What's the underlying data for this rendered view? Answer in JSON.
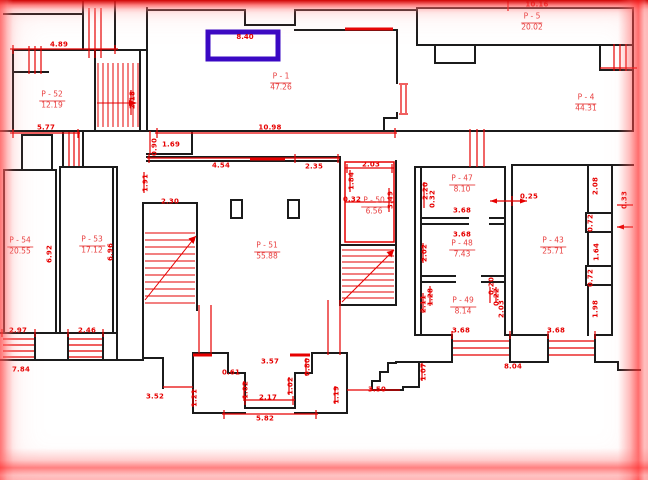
{
  "plan": {
    "colors": {
      "wall": "#1b1b1b",
      "annotation": "#e60000",
      "highlight": "#3a08c4",
      "background": "#ffffff"
    },
    "highlight": {
      "label": "8.40"
    },
    "rooms": [
      {
        "name": "P - 52",
        "area": "12.19",
        "x": 52,
        "y": 100
      },
      {
        "name": "P - 1",
        "area": "47.26",
        "x": 281,
        "y": 82
      },
      {
        "name": "P - 5",
        "area": "20.02",
        "x": 532,
        "y": 22
      },
      {
        "name": "P - 4",
        "area": "44.31",
        "x": 586,
        "y": 103
      },
      {
        "name": "P - 54",
        "area": "20.55",
        "x": 20,
        "y": 246
      },
      {
        "name": "P - 53",
        "area": "17.12",
        "x": 92,
        "y": 245
      },
      {
        "name": "P - 51",
        "area": "55.88",
        "x": 267,
        "y": 251
      },
      {
        "name": "P - 50",
        "area": "6.56",
        "x": 374,
        "y": 206
      },
      {
        "name": "P - 47",
        "area": "8.10",
        "x": 462,
        "y": 184
      },
      {
        "name": "P - 48",
        "area": "7.43",
        "x": 462,
        "y": 249
      },
      {
        "name": "P - 49",
        "area": "8.14",
        "x": 463,
        "y": 306
      },
      {
        "name": "P - 43",
        "area": "25.71",
        "x": 553,
        "y": 246
      }
    ],
    "dimensions": [
      {
        "t": "4.89",
        "x": 59,
        "y": 45
      },
      {
        "t": "10.16",
        "x": 537,
        "y": 5
      },
      {
        "t": "2.18",
        "x": 133,
        "y": 100,
        "r": 1
      },
      {
        "t": "5.77",
        "x": 46,
        "y": 128
      },
      {
        "t": "0.90",
        "x": 155,
        "y": 147,
        "r": 1
      },
      {
        "t": "1.69",
        "x": 171,
        "y": 145
      },
      {
        "t": "10.98",
        "x": 270,
        "y": 128
      },
      {
        "t": "4.54",
        "x": 221,
        "y": 166
      },
      {
        "t": "2.35",
        "x": 314,
        "y": 167
      },
      {
        "t": "2.03",
        "x": 371,
        "y": 165
      },
      {
        "t": "1.84",
        "x": 352,
        "y": 181,
        "r": 1
      },
      {
        "t": "0.32",
        "x": 352,
        "y": 200
      },
      {
        "t": "1.91",
        "x": 146,
        "y": 183,
        "r": 1
      },
      {
        "t": "2.30",
        "x": 170,
        "y": 202
      },
      {
        "t": "3.49",
        "x": 391,
        "y": 200,
        "r": 1
      },
      {
        "t": "2.20",
        "x": 426,
        "y": 191,
        "r": 1
      },
      {
        "t": "0.32",
        "x": 433,
        "y": 199,
        "r": 1
      },
      {
        "t": "3.68",
        "x": 462,
        "y": 211
      },
      {
        "t": "0.25",
        "x": 529,
        "y": 197
      },
      {
        "t": "3.68",
        "x": 462,
        "y": 235
      },
      {
        "t": "2.02",
        "x": 425,
        "y": 253,
        "r": 1
      },
      {
        "t": "2.08",
        "x": 596,
        "y": 186,
        "r": 1
      },
      {
        "t": "0.33",
        "x": 625,
        "y": 200,
        "r": 1
      },
      {
        "t": "0.72",
        "x": 591,
        "y": 223,
        "r": 1
      },
      {
        "t": "1.64",
        "x": 597,
        "y": 252,
        "r": 1
      },
      {
        "t": "0.72",
        "x": 591,
        "y": 278,
        "r": 1
      },
      {
        "t": "1.98",
        "x": 596,
        "y": 309,
        "r": 1
      },
      {
        "t": "6.92",
        "x": 50,
        "y": 254,
        "r": 1
      },
      {
        "t": "6.96",
        "x": 111,
        "y": 252,
        "r": 1
      },
      {
        "t": "2.11",
        "x": 424,
        "y": 304,
        "r": 1
      },
      {
        "t": "1.28",
        "x": 431,
        "y": 297,
        "r": 1
      },
      {
        "t": "0.20",
        "x": 492,
        "y": 286,
        "r": 1
      },
      {
        "t": "0.22",
        "x": 497,
        "y": 297,
        "r": 1
      },
      {
        "t": "2.03",
        "x": 502,
        "y": 309,
        "r": 1
      },
      {
        "t": "2.97",
        "x": 18,
        "y": 331
      },
      {
        "t": "2.46",
        "x": 87,
        "y": 331
      },
      {
        "t": "3.68",
        "x": 461,
        "y": 331
      },
      {
        "t": "3.68",
        "x": 556,
        "y": 331
      },
      {
        "t": "7.84",
        "x": 21,
        "y": 370
      },
      {
        "t": "3.57",
        "x": 270,
        "y": 362
      },
      {
        "t": "0.61",
        "x": 231,
        "y": 373
      },
      {
        "t": "0.80",
        "x": 308,
        "y": 367,
        "r": 1
      },
      {
        "t": "3.52",
        "x": 155,
        "y": 397
      },
      {
        "t": "1.21",
        "x": 195,
        "y": 398,
        "r": 1
      },
      {
        "t": "1.02",
        "x": 246,
        "y": 390,
        "r": 1
      },
      {
        "t": "1.02",
        "x": 291,
        "y": 386,
        "r": 1
      },
      {
        "t": "2.17",
        "x": 268,
        "y": 398
      },
      {
        "t": "1.19",
        "x": 337,
        "y": 395,
        "r": 1
      },
      {
        "t": "3.50",
        "x": 377,
        "y": 390
      },
      {
        "t": "5.82",
        "x": 265,
        "y": 419
      },
      {
        "t": "8.04",
        "x": 513,
        "y": 367
      },
      {
        "t": "1.07",
        "x": 424,
        "y": 372,
        "r": 1
      }
    ]
  }
}
